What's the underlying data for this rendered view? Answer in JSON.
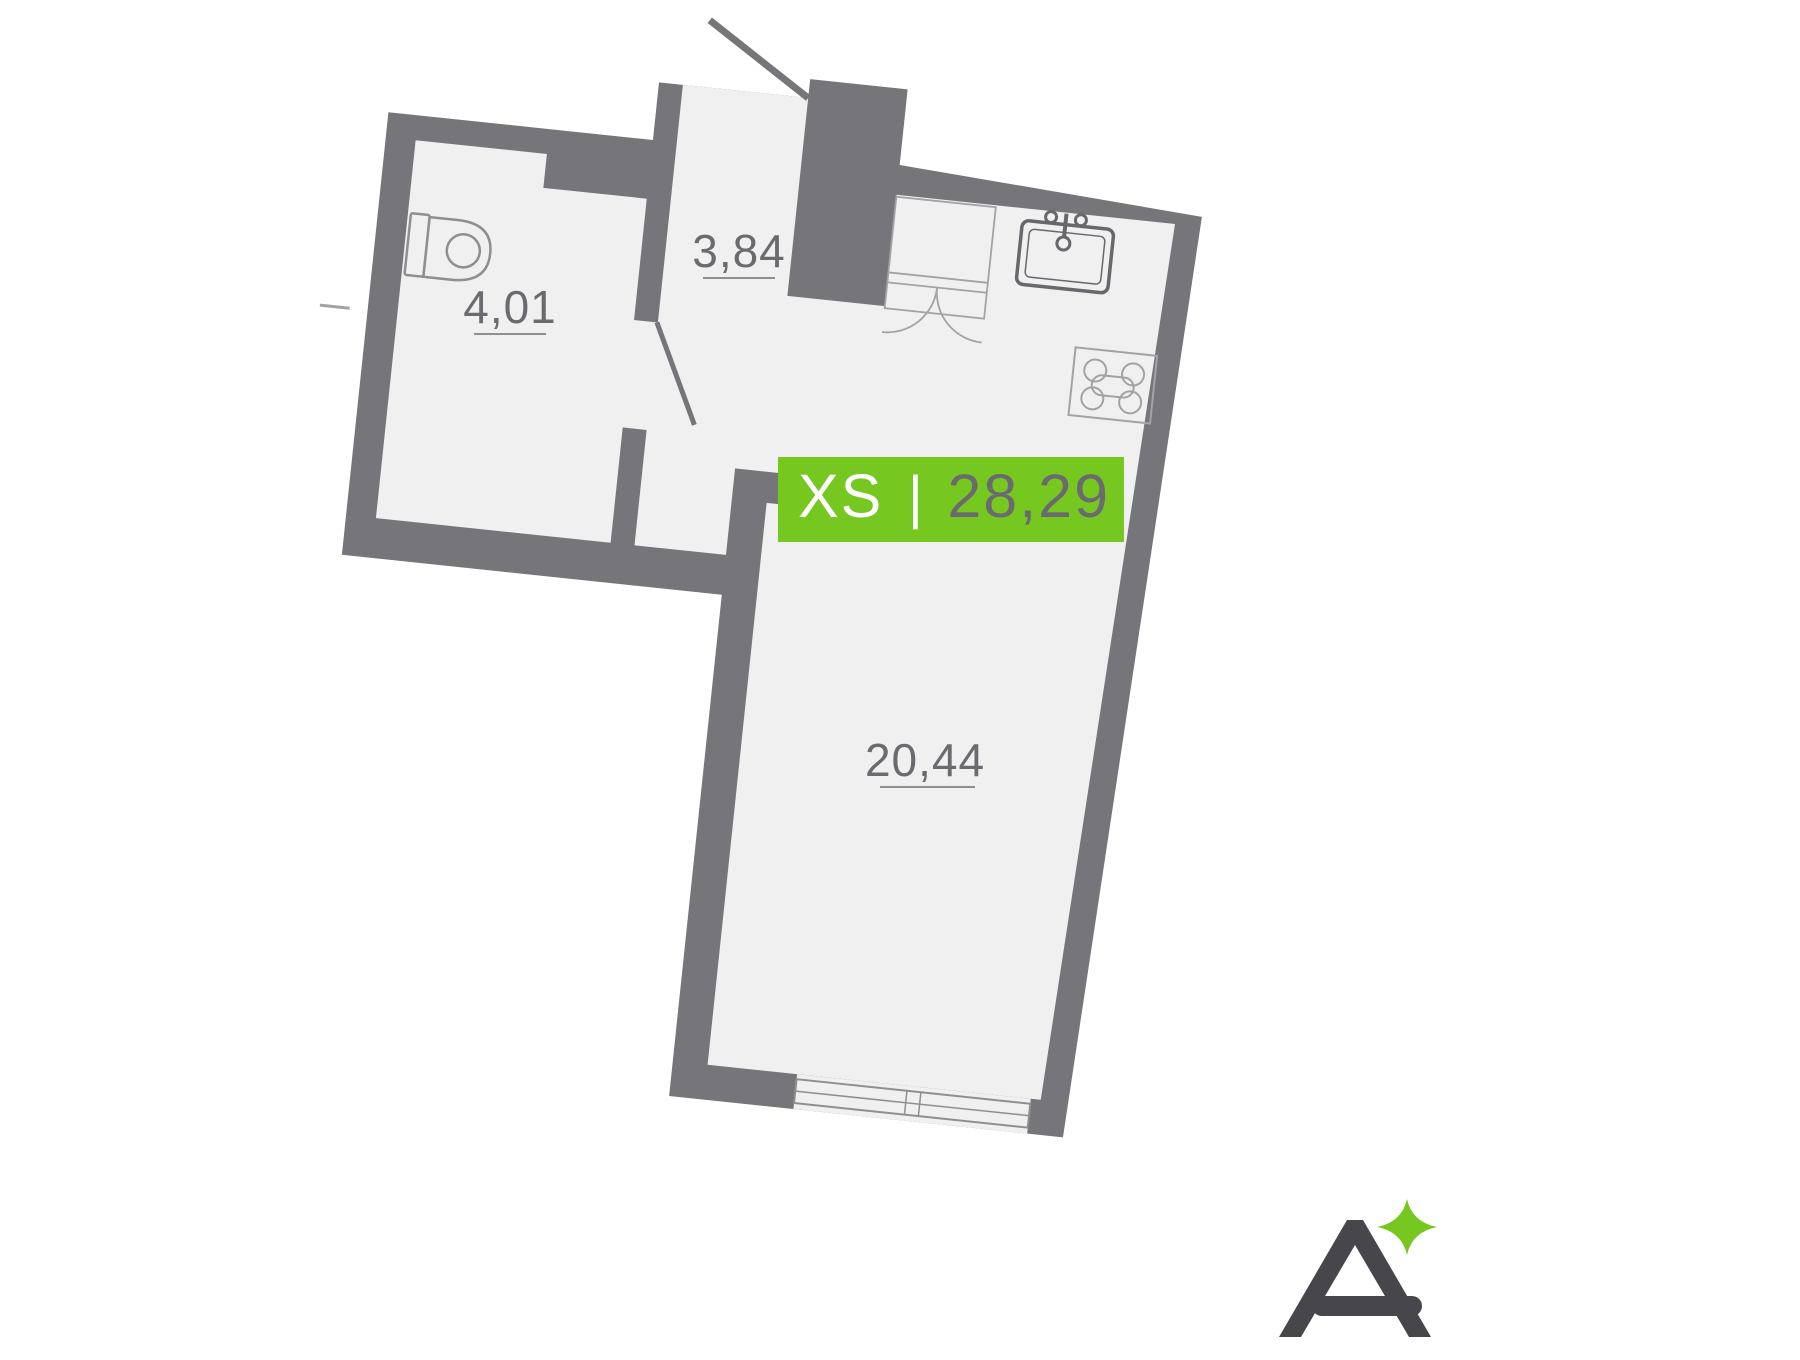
{
  "plan": {
    "rooms": [
      {
        "id": "bathroom",
        "area": "4,01"
      },
      {
        "id": "hallway",
        "area": "3,84"
      },
      {
        "id": "living-room",
        "area": "20,44"
      }
    ],
    "fixtures": [
      "toilet-icon",
      "sink-icon",
      "stove-icon",
      "wardrobe-icon",
      "window",
      "entry-door",
      "bathroom-door"
    ]
  },
  "badge": {
    "type": "XS",
    "separator": "|",
    "total_area": "28,29"
  },
  "logo": {
    "mark": "A-with-sparkle"
  },
  "colors": {
    "wall_gray": "#76767a",
    "floor_gray": "#f0f0f1",
    "badge_green": "#76c820",
    "badge_type_text": "#ffffff",
    "badge_area_text": "#6b6b6f",
    "room_label_text": "#6b6b6f",
    "fixture_light_stroke": "#a3a3a6",
    "fixture_dark_stroke": "#68686c",
    "logo_gray": "#47474b",
    "logo_sparkle_green": "#76c820",
    "background": "#ffffff"
  }
}
